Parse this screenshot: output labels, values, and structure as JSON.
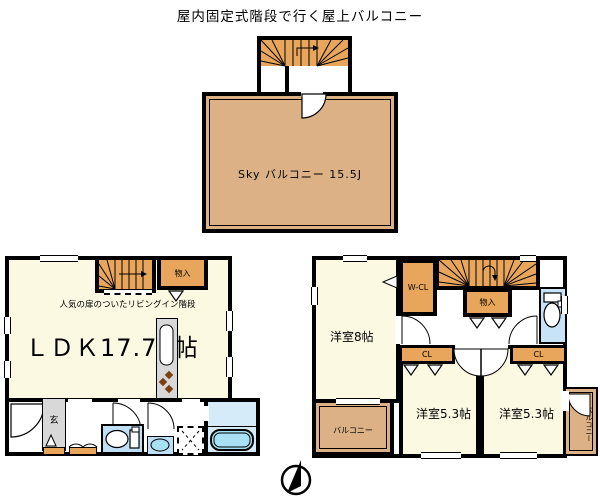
{
  "title": "屋内固定式階段で行く屋上バルコニー",
  "roof": {
    "balcony_label": "Sky バルコニー 15.5J"
  },
  "floor1": {
    "note": "人気の扉のついたリビングイン階段",
    "ldk_label": "ＬＤＫ17.75帖",
    "storage_label": "物入",
    "entrance_label": "玄"
  },
  "floor2": {
    "room8_label": "洋室8帖",
    "wcl_label": "W-CL",
    "storage_label": "物入",
    "cl_left_label": "CL",
    "cl_right_label": "CL",
    "room53_left_label": "洋室5.3帖",
    "room53_right_label": "洋室5.3帖",
    "balcony_label": "バルコニー",
    "side_balcony_label": "バルコニー"
  },
  "colors": {
    "stairs_closet_orange": "#E8A65C",
    "balcony_tan": "#DBB185",
    "room_cream": "#FBF9E2",
    "water_blue": "#C6E3F8",
    "bathtub_blue": "#A8E0F4",
    "hallway_gray": "#D8D8D8",
    "wall_black": "#000000"
  }
}
